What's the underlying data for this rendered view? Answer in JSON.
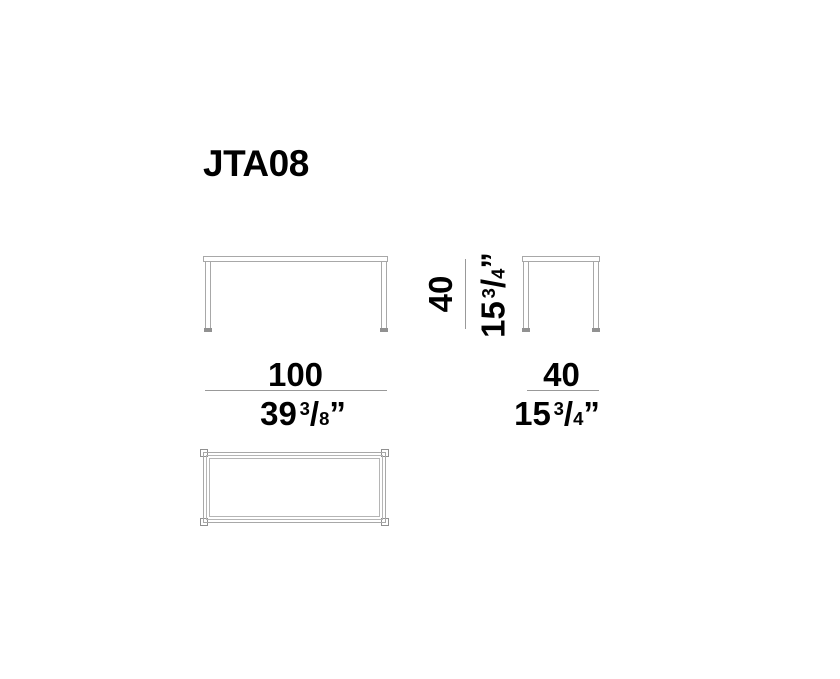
{
  "title": "JTA08",
  "colors": {
    "background": "#ffffff",
    "drawing_line": "#a8a8a8",
    "drawing_line_light": "#b5b5b5",
    "foot_fill": "#919191",
    "dimension_line": "#999999",
    "text": "#000000"
  },
  "views": {
    "front_elevation": "table front view",
    "side_elevation": "table side view",
    "top_plan": "table top view"
  },
  "dims": {
    "height": {
      "metric": "40",
      "imperial": {
        "whole": "15",
        "numerator": "3",
        "slash": "/",
        "denominator": "4",
        "unit": "”"
      }
    },
    "front_width": {
      "metric": "100",
      "imperial": {
        "whole": "39",
        "numerator": "3",
        "slash": "/",
        "denominator": "8",
        "unit": "”"
      }
    },
    "side_width": {
      "metric": "40",
      "imperial": {
        "whole": "15",
        "numerator": "3",
        "slash": "/",
        "denominator": "4",
        "unit": "”"
      }
    }
  }
}
